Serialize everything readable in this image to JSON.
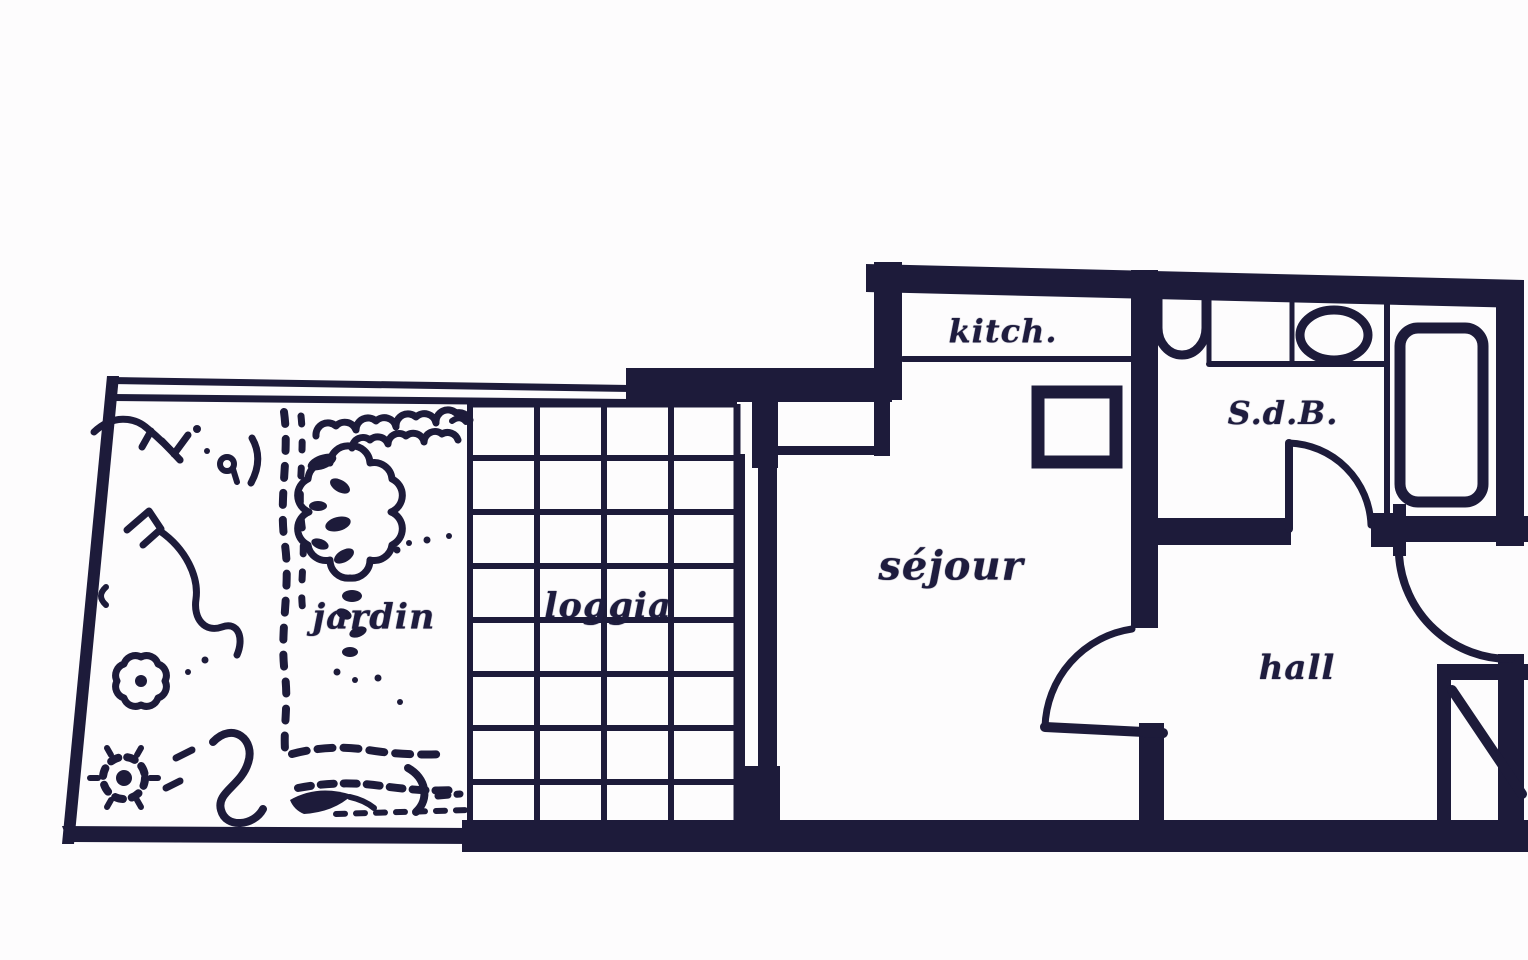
{
  "figure": {
    "type": "scanned apartment floor plan"
  },
  "colors": {
    "ink": "#1d1b3a",
    "paper": "#fdfcfd"
  },
  "rooms": {
    "jardin": {
      "label": "jardin"
    },
    "loggia": {
      "label": "loggia"
    },
    "sejour": {
      "label": "séjour"
    },
    "kitchen": {
      "label": "kitch."
    },
    "bathroom": {
      "label": "S.d.B."
    },
    "hall": {
      "label": "hall"
    }
  },
  "fixtures": [
    "toilet",
    "washbasin",
    "bathtub",
    "kitchen-counter",
    "bathroom-counter",
    "tiled-loggia-grid",
    "garden-plants",
    "sejour-hall-door",
    "bathroom-door",
    "entry-door",
    "window-bay",
    "corner-closet-diagonal"
  ]
}
